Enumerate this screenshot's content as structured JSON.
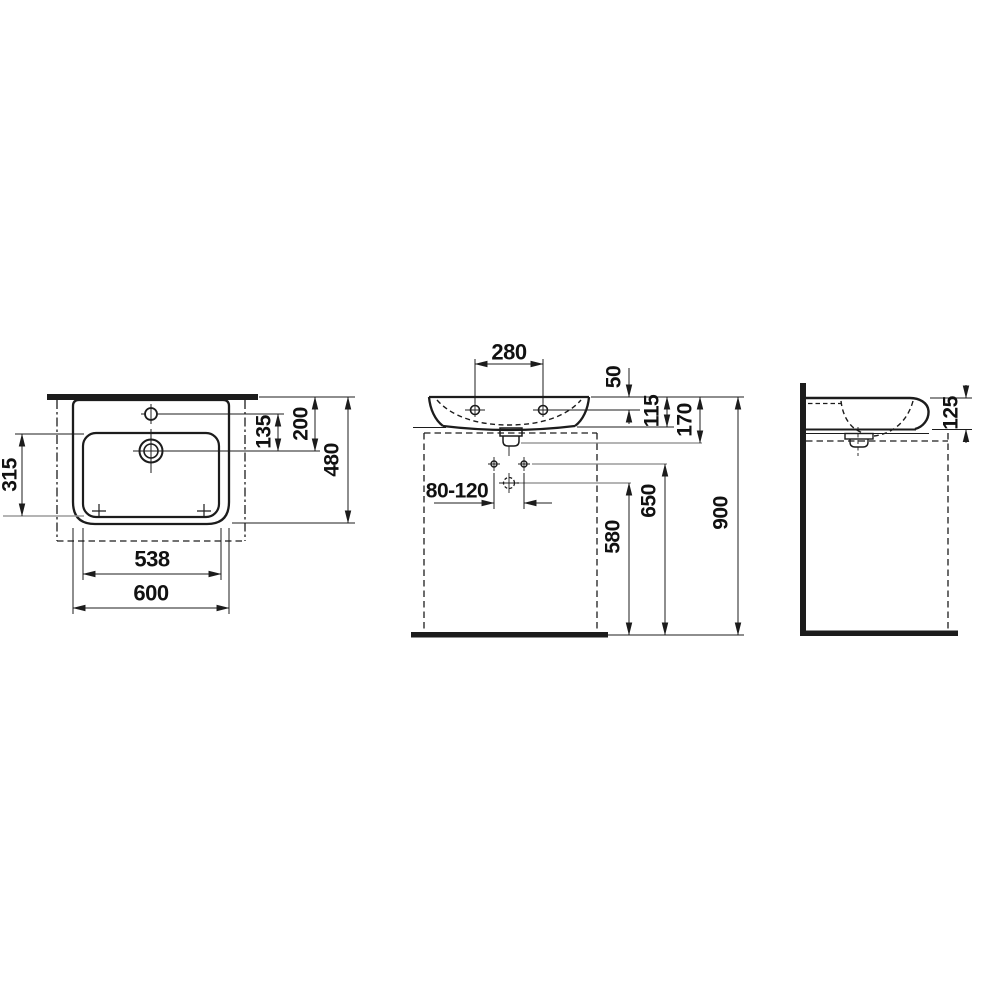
{
  "drawing": {
    "type": "washbasin-technical-drawing",
    "colors": {
      "line": "#1c1c1c",
      "reference_line": "#9b9b9b",
      "background": "#ffffff",
      "text": "#111111"
    },
    "dims": {
      "top_view": {
        "basin_depth": "315",
        "tap_to_drain": "135",
        "wall_to_drain": "200",
        "overall_depth": "480",
        "basin_width": "538",
        "overall_width": "600"
      },
      "front_view": {
        "tap_hole_spacing": "280",
        "rim_to_tap_holes": "50",
        "rim_to_underside": "115",
        "rim_to_outlet": "170",
        "inlet_offset_range": "80-120",
        "floor_to_inlet": "580",
        "floor_to_fixing_holes": "650",
        "floor_to_rim": "900"
      },
      "side_view": {
        "front_edge_height": "125"
      }
    }
  }
}
